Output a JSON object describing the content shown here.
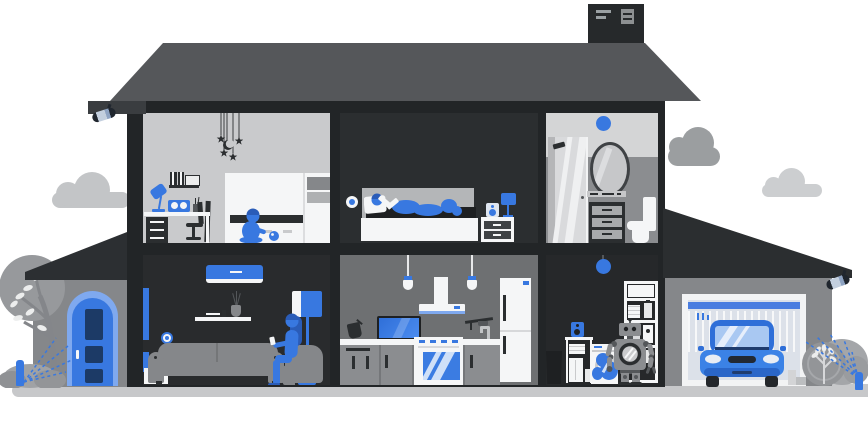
{
  "illustration": {
    "title": "Smart home cutaway house",
    "style": "flat vector illustration, grayscale house with blue smart-home accents, no visible text",
    "palette": {
      "accent_blue": "#3878e0",
      "light_blue": "#7fa9ef",
      "pale_blue": "#a9c8f2",
      "navy": "#1c3a66",
      "roof_gray": "#55575a",
      "frame_dark": "#222527",
      "room_light": "#c9cacc",
      "room_dark": "#2a2d30",
      "kitchen_gray": "#6e7072",
      "facade_gray": "#85878a",
      "ground_gray": "#c7c8ca",
      "furniture_white": "#f5f6f7"
    },
    "exterior": {
      "clouds": 3,
      "rooftop_vent": "dark vent unit on top of roof",
      "security_cameras": [
        "camera under left eave",
        "camera under garage eave"
      ],
      "front_door": "blue arched door with three navy panels and white handle",
      "left_yard": [
        "gray tree with white leaves",
        "bushes",
        "sprinkler watering tree"
      ],
      "right_yard": [
        "round bush with white-leaf sapling",
        "sprinkler watering bush"
      ]
    },
    "rooms": [
      {
        "name": "kids-room",
        "floor": "upper",
        "objects": [
          "stars-and-moon mobile",
          "wall shelf with books and picture",
          "blue desk lamp",
          "blue radio with two speakers",
          "white desk with drawer unit",
          "office chair",
          "easel",
          "white bunk bed with linens",
          "child playing with ball"
        ]
      },
      {
        "name": "bedroom",
        "floor": "upper",
        "objects": [
          "wall sensor",
          "person reading in bed",
          "gray headboard",
          "white bed base",
          "nightstand with two drawers",
          "speaker",
          "blue bedside lamp"
        ]
      },
      {
        "name": "bathroom",
        "floor": "upper",
        "objects": [
          "blue ceiling sensor",
          "glass shower cabin",
          "oval mirror",
          "vanity counter",
          "dark cabinet with three drawers",
          "toilet"
        ]
      },
      {
        "name": "living-room",
        "floor": "ground",
        "objects": [
          "blue air conditioner",
          "blue curtain",
          "wall sensor",
          "shelf with books and vase",
          "gray sofa",
          "woman in armchair using phone",
          "blue floor lamp",
          "white cabinet"
        ]
      },
      {
        "name": "kitchen",
        "floor": "ground",
        "objects": [
          "two pendant lamps",
          "range hood with blue stripe",
          "tv on counter",
          "kettle",
          "stove with blue oven window",
          "utensil rail and faucet",
          "base cabinets",
          "fridge with blue display"
        ]
      },
      {
        "name": "laundry-room",
        "floor": "ground",
        "objects": [
          "blue pendant ball lamp",
          "storage shelving with towels and detergent",
          "washing machine with water splash",
          "household robot",
          "blue speaker on side shelf",
          "trash bin"
        ]
      },
      {
        "name": "garage",
        "floor": "ground",
        "objects": [
          "roll-up garage door with blue stripe",
          "blue car front view",
          "entry steps",
          "security camera"
        ]
      }
    ]
  }
}
